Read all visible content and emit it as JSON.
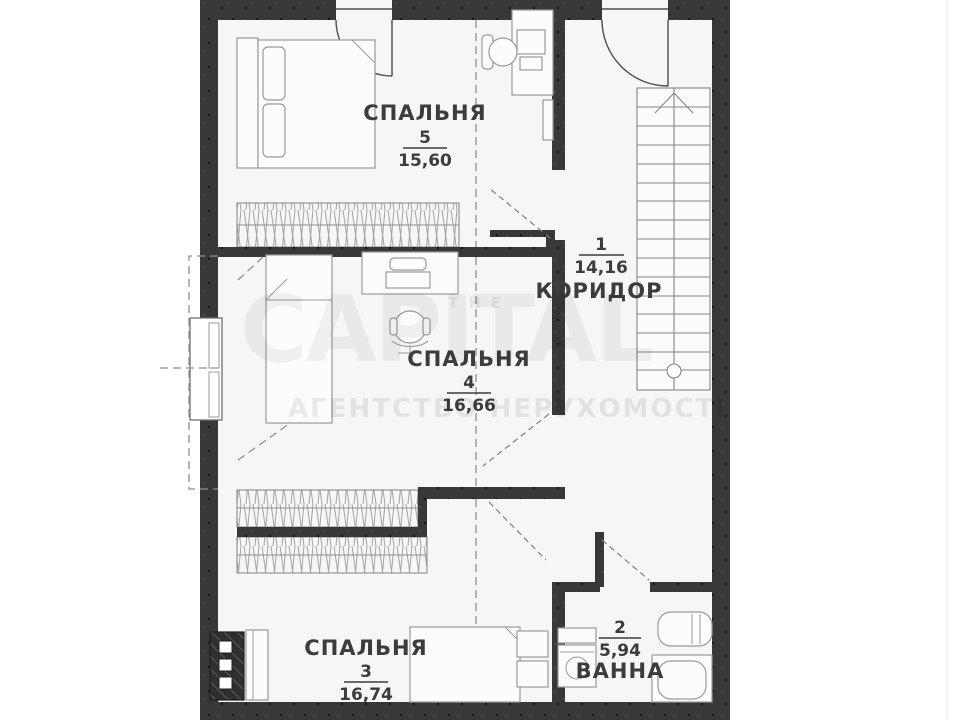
{
  "plan": {
    "rooms": [
      {
        "id": "bedroom-5",
        "name": "СПАЛЬНЯ",
        "number": "5",
        "area": "15,60"
      },
      {
        "id": "corridor",
        "name": "КОРИДОР",
        "number": "1",
        "area": "14,16"
      },
      {
        "id": "bedroom-4",
        "name": "СПАЛЬНЯ",
        "number": "4",
        "area": "16,66"
      },
      {
        "id": "bedroom-3",
        "name": "СПАЛЬНЯ",
        "number": "3",
        "area": "16,74"
      },
      {
        "id": "bathroom",
        "name": "ВАННА",
        "number": "2",
        "area": "5,94"
      }
    ]
  },
  "watermark": {
    "prefix": "THE",
    "brand": "CAPITAL",
    "tagline": "АГЕНТСТВО НЕРУХОМОСТІ"
  },
  "colors": {
    "wall": "#383838",
    "floor": "#f6f6f4",
    "furniture_outline": "#9a9a9a",
    "label_text": "#3c3c3c",
    "watermark": "rgba(0,0,0,0.05)"
  }
}
